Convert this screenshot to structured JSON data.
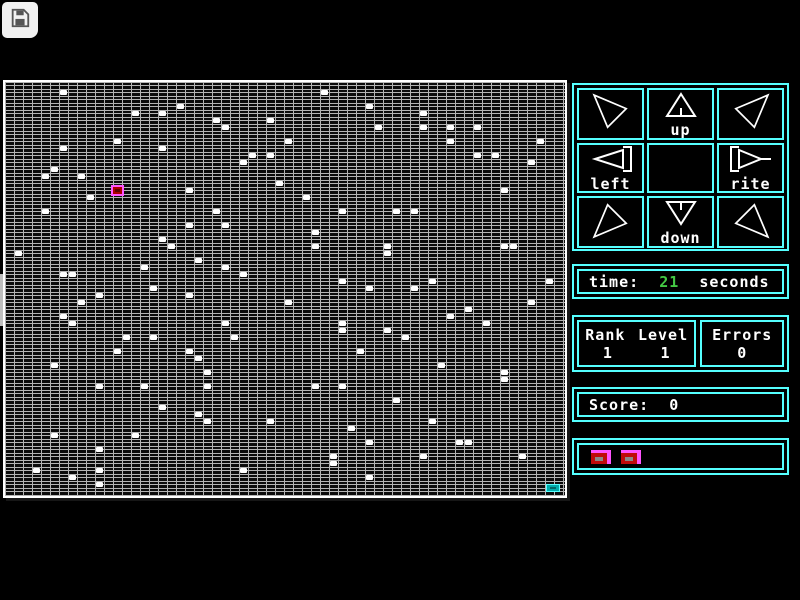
{
  "icons": {
    "save": "floppy-disk-icon",
    "side_tab": "chevron-right-icon",
    "pad_corners": [
      "arrow-up-left-icon",
      "arrow-up-right-icon",
      "arrow-down-left-icon",
      "arrow-down-right-icon"
    ]
  },
  "side_tab": {
    "chevron": "›"
  },
  "pad": {
    "up_label": "up",
    "left_label": "left",
    "rite_label": "rite",
    "down_label": "down"
  },
  "time_panel": {
    "label": "time:",
    "value": "21",
    "unit": "seconds"
  },
  "rank_panel": {
    "rank_label": "Rank",
    "level_label": "Level",
    "rank_value": "1",
    "level_value": "1"
  },
  "errors_panel": {
    "label": "Errors",
    "value": "0"
  },
  "score_panel": {
    "label": "Score:",
    "value": "0"
  },
  "colors": {
    "accent_cyan": "#55FFFF",
    "time_value_green": "#44C944",
    "text_white": "#FFFFFF",
    "grid_line_gray": "#B4B4B4",
    "player_fill": "#AA0000",
    "player_border": "#FF55FF",
    "goal_fill": "#00AAAA",
    "button_pink": "#FF55FF",
    "button_red": "#BF0A0A"
  },
  "grid": {
    "cols": 62,
    "rows": 59,
    "cell_w": 9,
    "cell_h": 7,
    "player": {
      "col": 12,
      "row": 15
    },
    "goal": {
      "col": 60,
      "row": 57
    },
    "dots": [
      [
        6,
        1
      ],
      [
        19,
        3
      ],
      [
        14,
        4
      ],
      [
        17,
        4
      ],
      [
        23,
        5
      ],
      [
        29,
        5
      ],
      [
        24,
        6
      ],
      [
        12,
        8
      ],
      [
        6,
        9
      ],
      [
        17,
        9
      ],
      [
        27,
        10
      ],
      [
        29,
        10
      ],
      [
        26,
        11
      ],
      [
        5,
        12
      ],
      [
        4,
        13
      ],
      [
        8,
        13
      ],
      [
        30,
        14
      ],
      [
        20,
        15
      ],
      [
        9,
        16
      ],
      [
        4,
        18
      ],
      [
        23,
        18
      ],
      [
        20,
        20
      ],
      [
        24,
        20
      ],
      [
        17,
        22
      ],
      [
        18,
        23
      ],
      [
        1,
        24
      ],
      [
        21,
        25
      ],
      [
        15,
        26
      ],
      [
        24,
        26
      ],
      [
        6,
        27
      ],
      [
        7,
        27
      ],
      [
        26,
        27
      ],
      [
        35,
        1
      ],
      [
        40,
        3
      ],
      [
        46,
        4
      ],
      [
        41,
        6
      ],
      [
        46,
        6
      ],
      [
        49,
        6
      ],
      [
        52,
        6
      ],
      [
        31,
        8
      ],
      [
        49,
        8
      ],
      [
        59,
        8
      ],
      [
        52,
        10
      ],
      [
        54,
        10
      ],
      [
        58,
        11
      ],
      [
        55,
        15
      ],
      [
        33,
        16
      ],
      [
        37,
        18
      ],
      [
        43,
        18
      ],
      [
        45,
        18
      ],
      [
        34,
        21
      ],
      [
        34,
        23
      ],
      [
        42,
        23
      ],
      [
        55,
        23
      ],
      [
        56,
        23
      ],
      [
        42,
        24
      ],
      [
        37,
        28
      ],
      [
        47,
        28
      ],
      [
        60,
        28
      ],
      [
        40,
        29
      ],
      [
        16,
        29
      ],
      [
        10,
        30
      ],
      [
        20,
        30
      ],
      [
        8,
        31
      ],
      [
        31,
        31
      ],
      [
        6,
        33
      ],
      [
        7,
        34
      ],
      [
        24,
        34
      ],
      [
        13,
        36
      ],
      [
        16,
        36
      ],
      [
        25,
        36
      ],
      [
        12,
        38
      ],
      [
        20,
        38
      ],
      [
        21,
        39
      ],
      [
        5,
        40
      ],
      [
        22,
        41
      ],
      [
        10,
        43
      ],
      [
        15,
        43
      ],
      [
        22,
        43
      ],
      [
        17,
        46
      ],
      [
        21,
        47
      ],
      [
        22,
        48
      ],
      [
        29,
        48
      ],
      [
        5,
        50
      ],
      [
        14,
        50
      ],
      [
        10,
        52
      ],
      [
        3,
        55
      ],
      [
        10,
        55
      ],
      [
        26,
        55
      ],
      [
        7,
        56
      ],
      [
        10,
        57
      ],
      [
        45,
        29
      ],
      [
        58,
        31
      ],
      [
        51,
        32
      ],
      [
        49,
        33
      ],
      [
        53,
        34
      ],
      [
        37,
        34
      ],
      [
        37,
        35
      ],
      [
        42,
        35
      ],
      [
        44,
        36
      ],
      [
        39,
        38
      ],
      [
        48,
        40
      ],
      [
        55,
        41
      ],
      [
        55,
        42
      ],
      [
        34,
        43
      ],
      [
        37,
        43
      ],
      [
        43,
        45
      ],
      [
        47,
        48
      ],
      [
        38,
        49
      ],
      [
        40,
        51
      ],
      [
        50,
        51
      ],
      [
        51,
        51
      ],
      [
        36,
        53
      ],
      [
        46,
        53
      ],
      [
        57,
        53
      ],
      [
        36,
        54
      ],
      [
        40,
        56
      ]
    ]
  }
}
